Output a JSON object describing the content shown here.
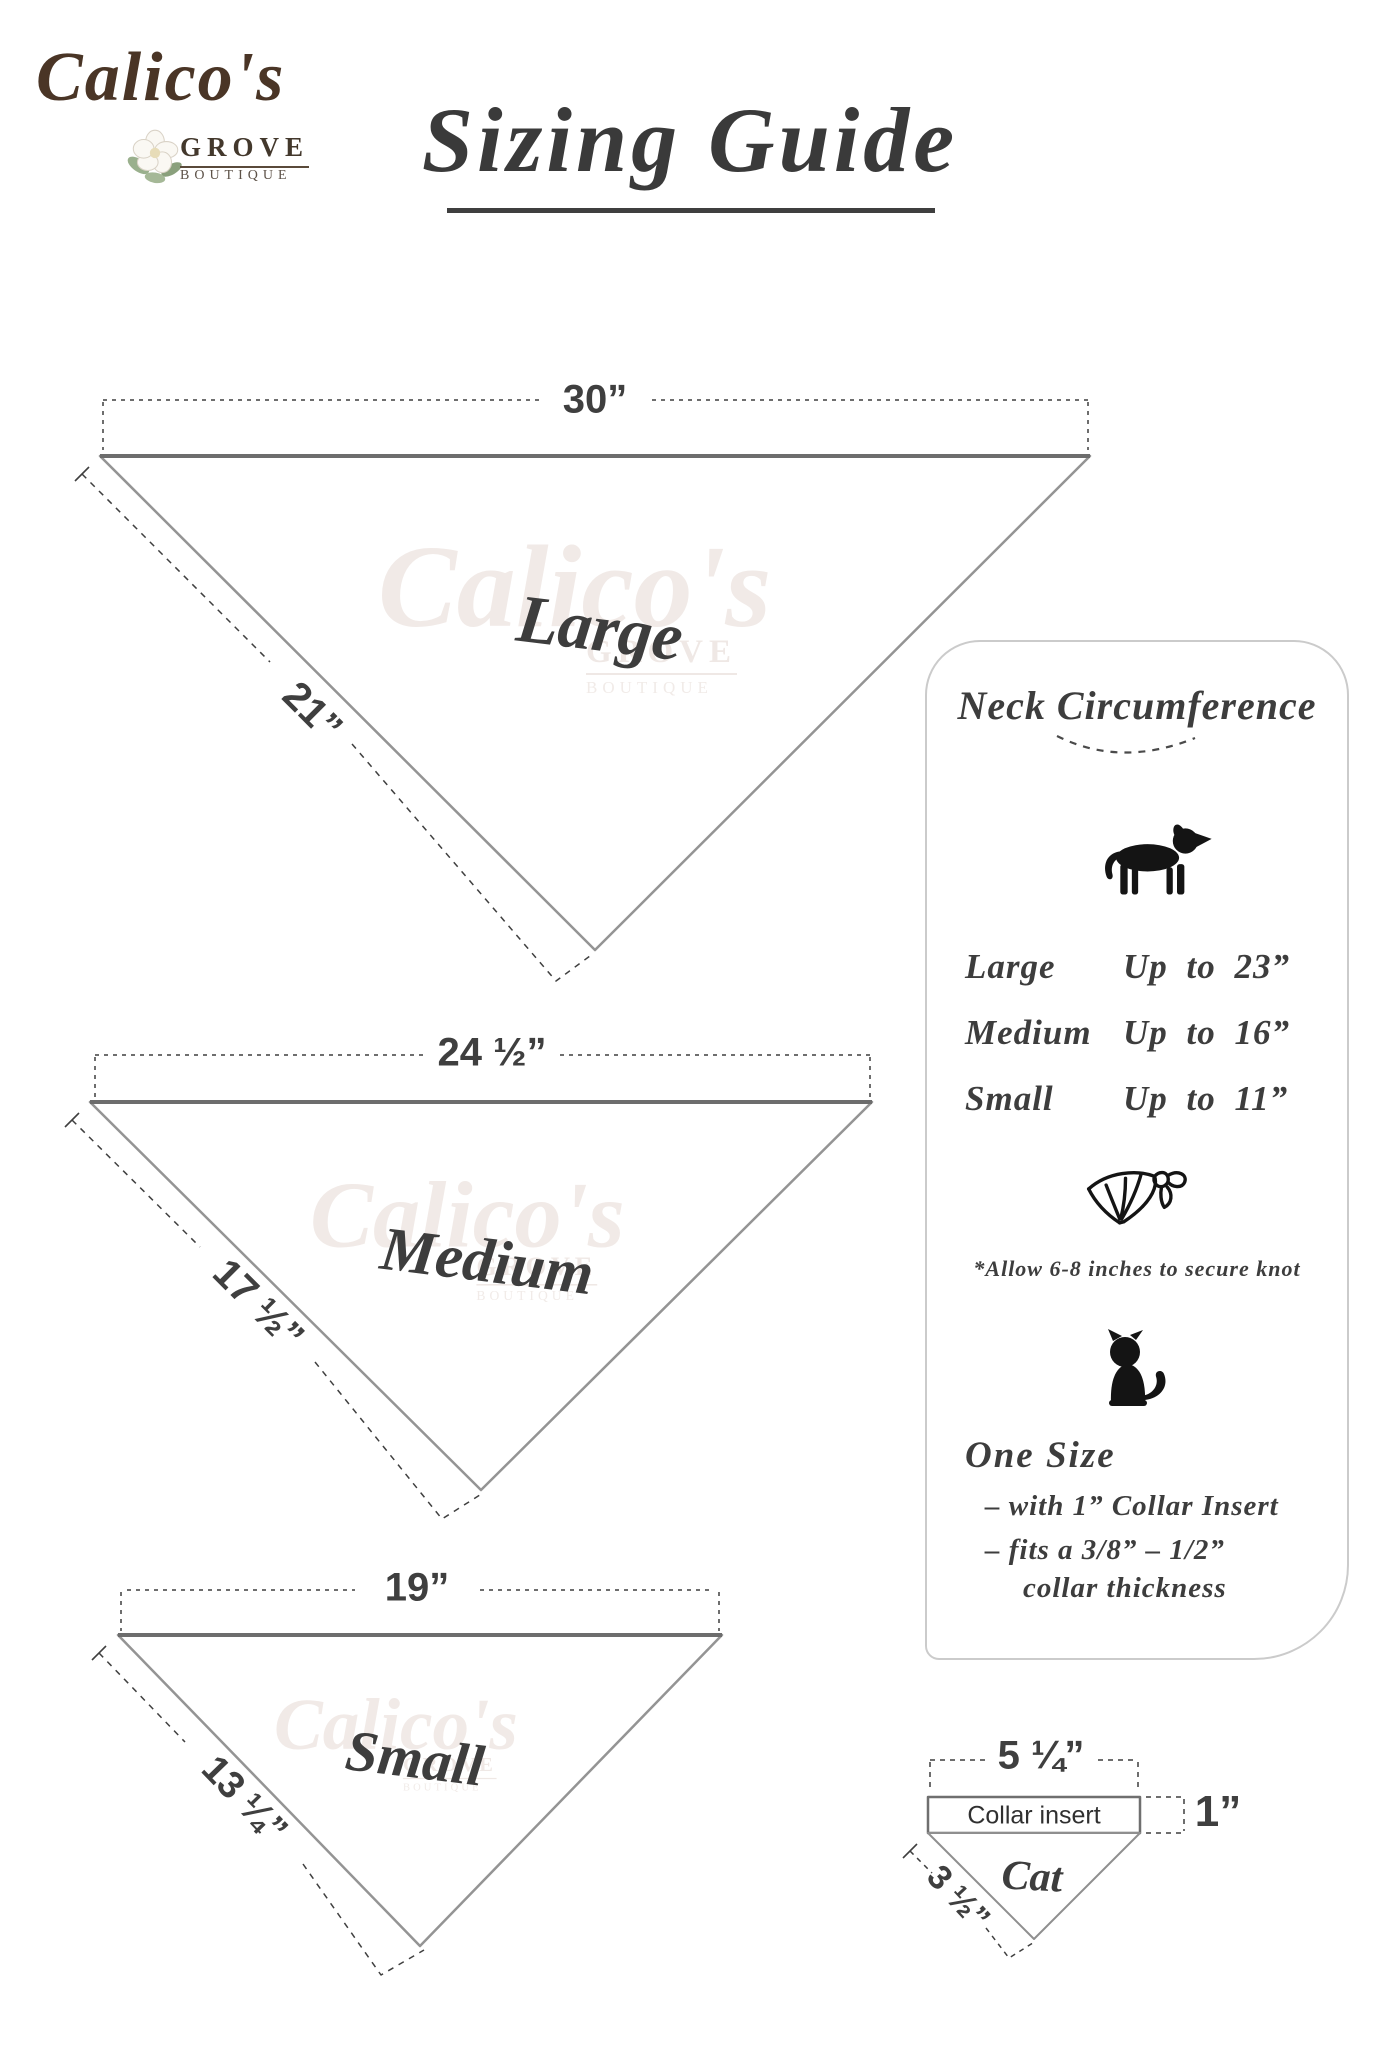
{
  "brand": {
    "name": "Calico's",
    "sub1": "GROVE",
    "sub2": "BOUTIQUE"
  },
  "title": {
    "text": "Sizing Guide"
  },
  "bandanas": [
    {
      "name": "Large",
      "top_width": "30”",
      "side_length": "21”"
    },
    {
      "name": "Medium",
      "top_width": "24 ½”",
      "side_length": "17 ½”"
    },
    {
      "name": "Small",
      "top_width": "19”",
      "side_length": "13 ¼”"
    }
  ],
  "panel": {
    "title": "Neck Circumference",
    "sizes": [
      {
        "label": "Large",
        "value": "Up to 23”"
      },
      {
        "label": "Medium",
        "value": "Up to 16”"
      },
      {
        "label": "Small",
        "value": "Up to 11”"
      }
    ],
    "knot_note": "*Allow 6-8 inches to secure knot",
    "one_size": {
      "title": "One Size",
      "lines": [
        "– with 1” Collar Insert",
        "– fits a 3/8” – 1/2”",
        "collar thickness"
      ]
    }
  },
  "cat_diagram": {
    "top_width": "5 ¼”",
    "insert_label": "Collar insert",
    "insert_height": "1”",
    "side_length": "3 ½”",
    "name": "Cat"
  },
  "watermark": {
    "name": "Calico's",
    "sub1": "GROVE",
    "sub2": "BOUTIQUE"
  },
  "colors": {
    "brand_brown": "#4a3526",
    "ink": "#3d3d3d",
    "line_gray": "#8f8f8f",
    "icon_black": "#141414",
    "watermark": "#f1eae7",
    "leaf_green": "#9ab08d"
  }
}
